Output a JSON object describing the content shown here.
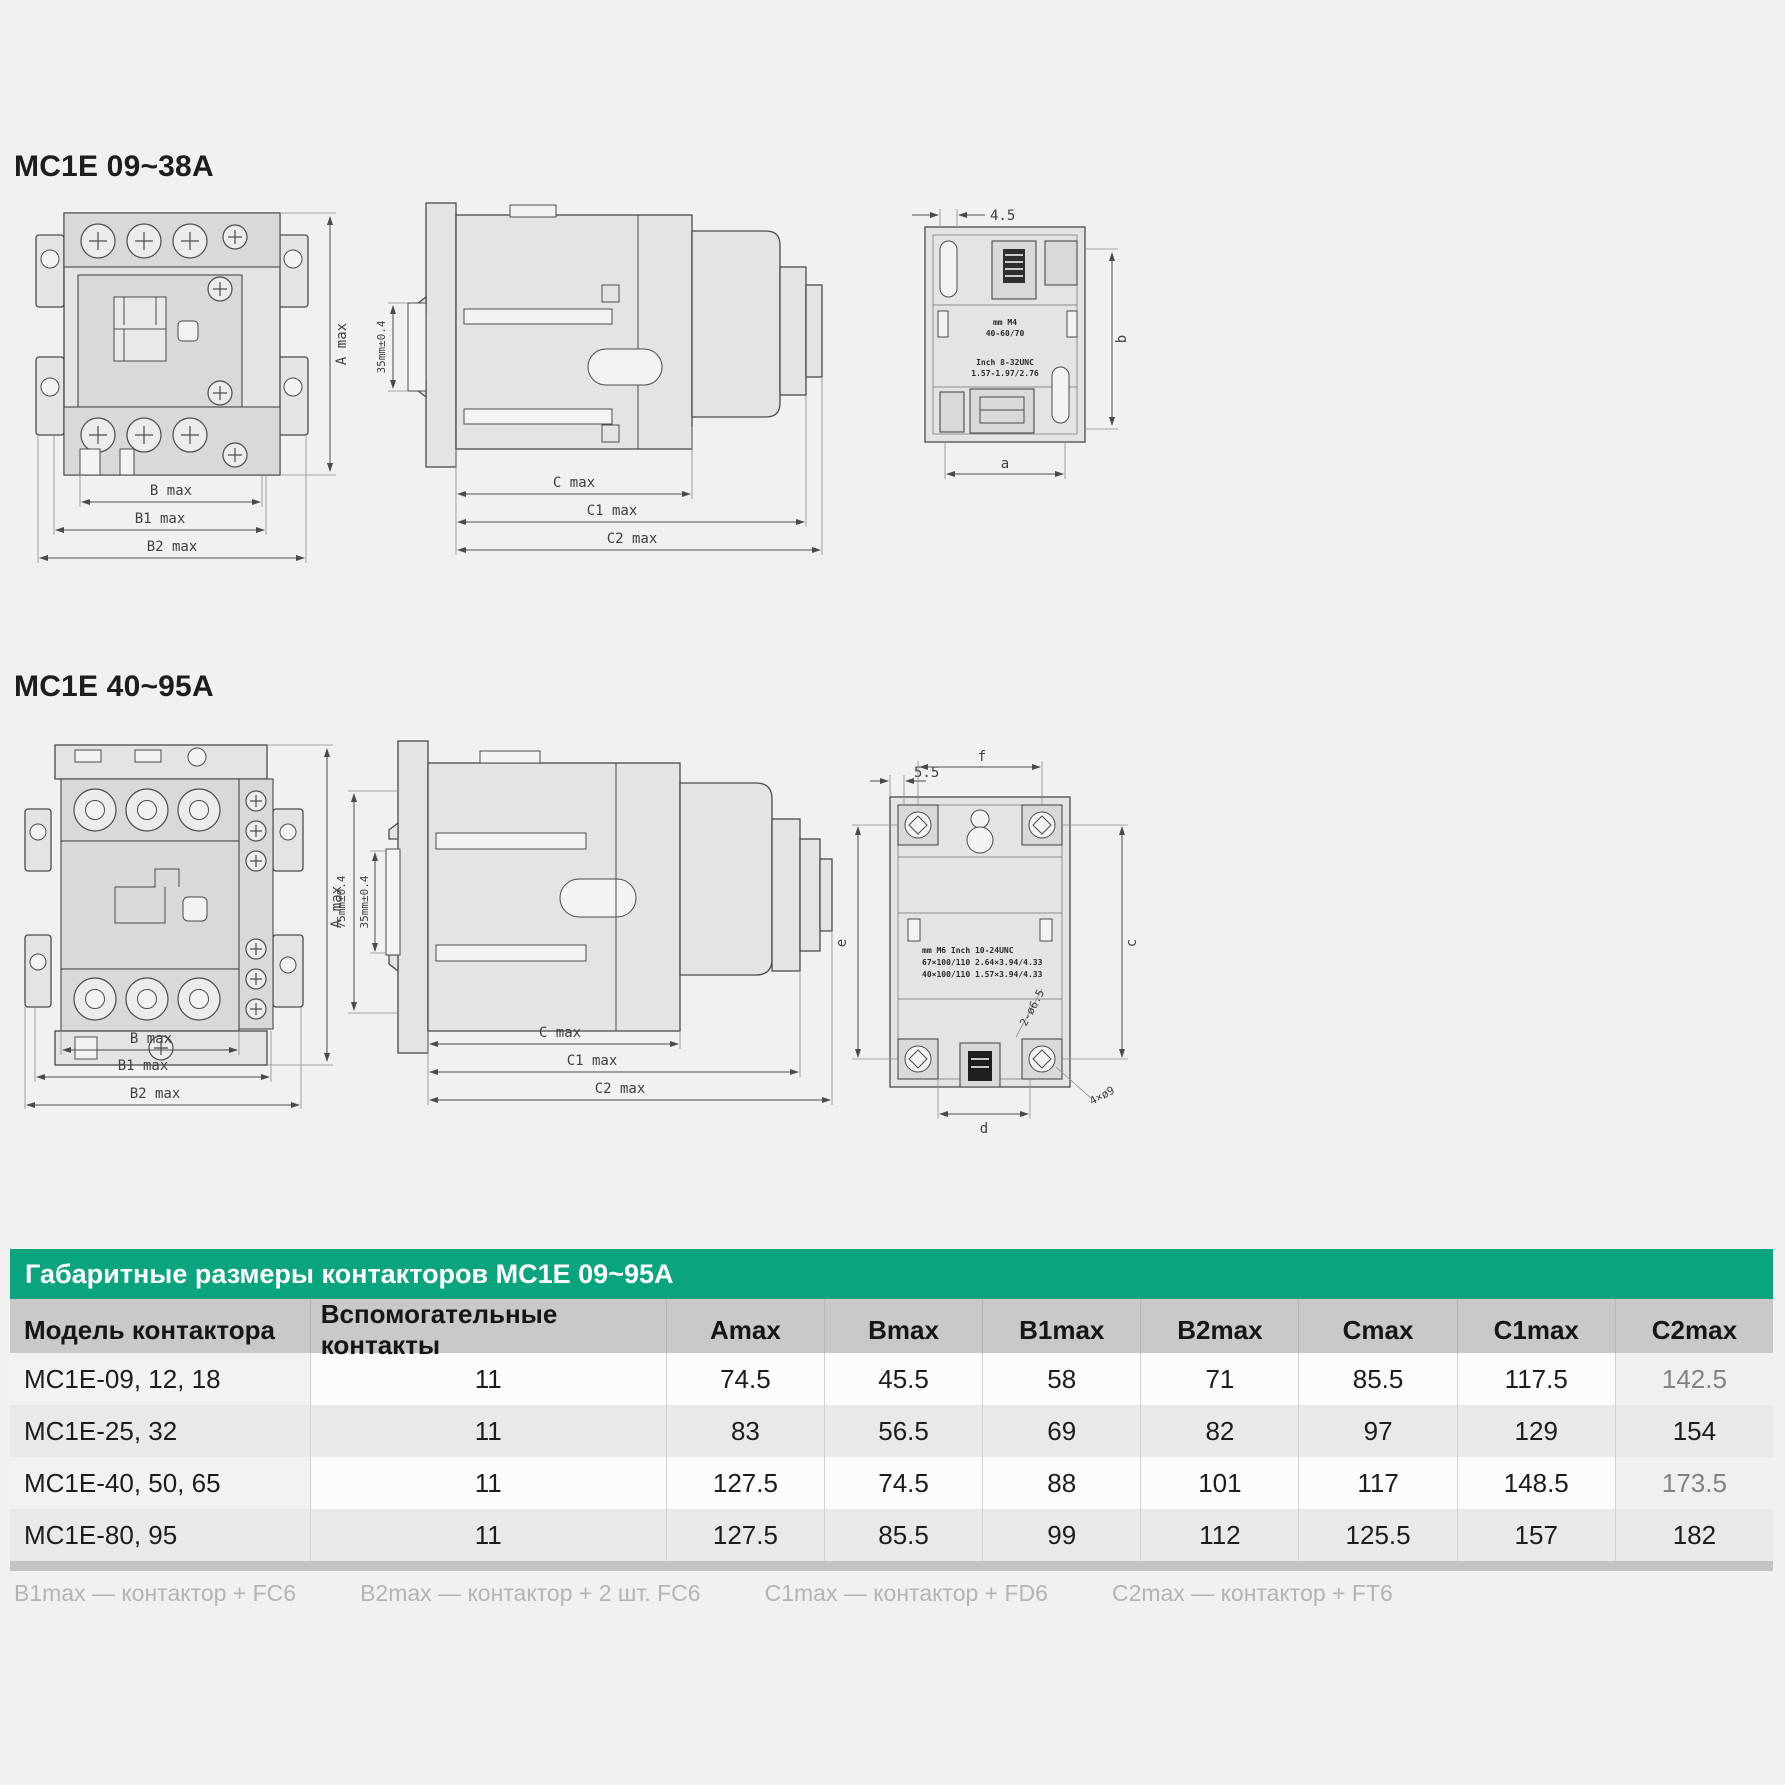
{
  "sections": [
    {
      "title": "MC1E 09~38A"
    },
    {
      "title": "MC1E 40~95A"
    }
  ],
  "drawings": {
    "a_max": "A max",
    "b_max": "B max",
    "b1_max": "B1 max",
    "b2_max": "B2 max",
    "c_max": "C max",
    "c1_max": "C1 max",
    "c2_max": "C2 max",
    "small_rail": "35mm±0.4",
    "small_rear_offset": "4.5",
    "small_rear_b": "b",
    "small_rear_a": "a",
    "small_plate_1": "mm   M4",
    "small_plate_2": "40-60/70",
    "small_plate_3": "Inch 8-32UNC",
    "small_plate_4": "1.57-1.97/2.76",
    "large_rail_75": "75mm±0.4",
    "large_rail_35": "35mm±0.4",
    "large_rear_offset": "5.5",
    "large_rear_f": "f",
    "large_rear_e": "e",
    "large_rear_c": "c",
    "large_rear_d": "d",
    "large_rear_slot": "2-ø6.5",
    "large_rear_holes": "4×ø9",
    "large_plate_1": "mm    M6    Inch 10-24UNC",
    "large_plate_2": "67×100/110   2.64×3.94/4.33",
    "large_plate_3": "40×100/110   1.57×3.94/4.33"
  },
  "table": {
    "title": "Габаритные размеры контакторов MC1E 09~95A",
    "columns": [
      "Модель контактора",
      "Вспомогательные контакты",
      "Amax",
      "Bmax",
      "B1max",
      "B2max",
      "Cmax",
      "C1max",
      "C2max"
    ],
    "rows": [
      {
        "model": "MC1E-09, 12, 18",
        "aux": "11",
        "amax": "74.5",
        "bmax": "45.5",
        "b1max": "58",
        "b2max": "71",
        "cmax": "85.5",
        "c1max": "117.5",
        "c2max": "142.5"
      },
      {
        "model": "MC1E-25, 32",
        "aux": "11",
        "amax": "83",
        "bmax": "56.5",
        "b1max": "69",
        "b2max": "82",
        "cmax": "97",
        "c1max": "129",
        "c2max": "154"
      },
      {
        "model": "MC1E-40, 50, 65",
        "aux": "11",
        "amax": "127.5",
        "bmax": "74.5",
        "b1max": "88",
        "b2max": "101",
        "cmax": "117",
        "c1max": "148.5",
        "c2max": "173.5"
      },
      {
        "model": "MC1E-80, 95",
        "aux": "11",
        "amax": "127.5",
        "bmax": "85.5",
        "b1max": "99",
        "b2max": "112",
        "cmax": "125.5",
        "c1max": "157",
        "c2max": "182"
      }
    ],
    "notes": [
      "B1max — контактор + FC6",
      "B2max — контактор + 2 шт. FC6",
      "C1max — контактор + FD6",
      "C2max — контактор + FT6"
    ]
  },
  "colors": {
    "accent_green": "#0aa57e",
    "header_gray": "#c9c9c9",
    "page_bg": "#f1f1f1"
  }
}
